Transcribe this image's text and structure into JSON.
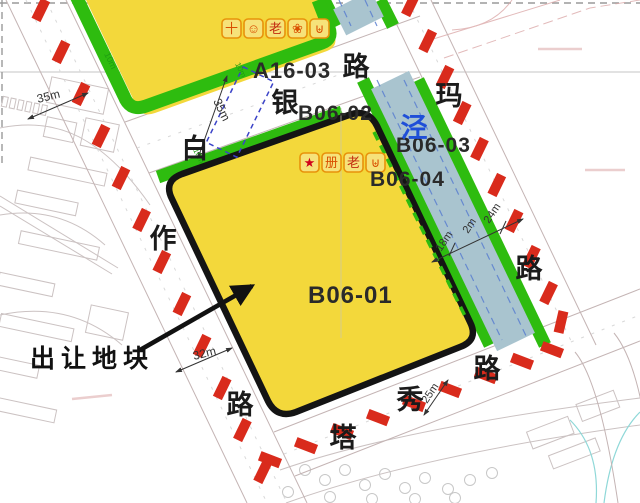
{
  "map": {
    "colors": {
      "parcel_yellow": "#F3D83B",
      "buffer_green": "#2EBC0F",
      "river_blue": "#A9C4CF",
      "road_marker_red": "#D92B1C",
      "parcel_border_black": "#141414",
      "river_label_blue": "#1F4FD8",
      "icon_orange": "#E8920A"
    },
    "parcels": {
      "a16_03": "A16-03",
      "b06_01": "B06-01",
      "b06_02": "B06-02",
      "b06_03": "B06-03",
      "b06_04": "B06-04"
    },
    "road_chars": {
      "bai": "白",
      "yin": "银",
      "lu_top": "路",
      "ma": "玛",
      "zuo": "作",
      "lu_left": "路",
      "lu_right": "路",
      "ta": "塔",
      "xiu": "秀",
      "lu_bottom": "路"
    },
    "river_char": "泾",
    "callout": {
      "label": "出让地块"
    },
    "dimensions": {
      "d35_left": "35m",
      "d10_left": "10m",
      "d35_cross": "35m",
      "d10_cross_a": "10m",
      "d10_cross_b": "10m",
      "d32": "32m",
      "d18": "18m",
      "d2": "2m",
      "d24": "24m",
      "d25": "25m"
    },
    "icons": {
      "a16_row": [
        {
          "name": "cross-icon",
          "glyph": "十"
        },
        {
          "name": "smiley-icon",
          "glyph": "☺"
        },
        {
          "name": "elder-icon",
          "glyph": "老"
        },
        {
          "name": "flower-icon",
          "glyph": "❀"
        },
        {
          "name": "basket-icon",
          "glyph": "⊎"
        }
      ],
      "b06_row": [
        {
          "name": "star-icon",
          "glyph": "★"
        },
        {
          "name": "book-icon",
          "glyph": "册"
        },
        {
          "name": "elder-icon",
          "glyph": "老"
        },
        {
          "name": "basket-icon",
          "glyph": "⊎"
        }
      ]
    }
  }
}
